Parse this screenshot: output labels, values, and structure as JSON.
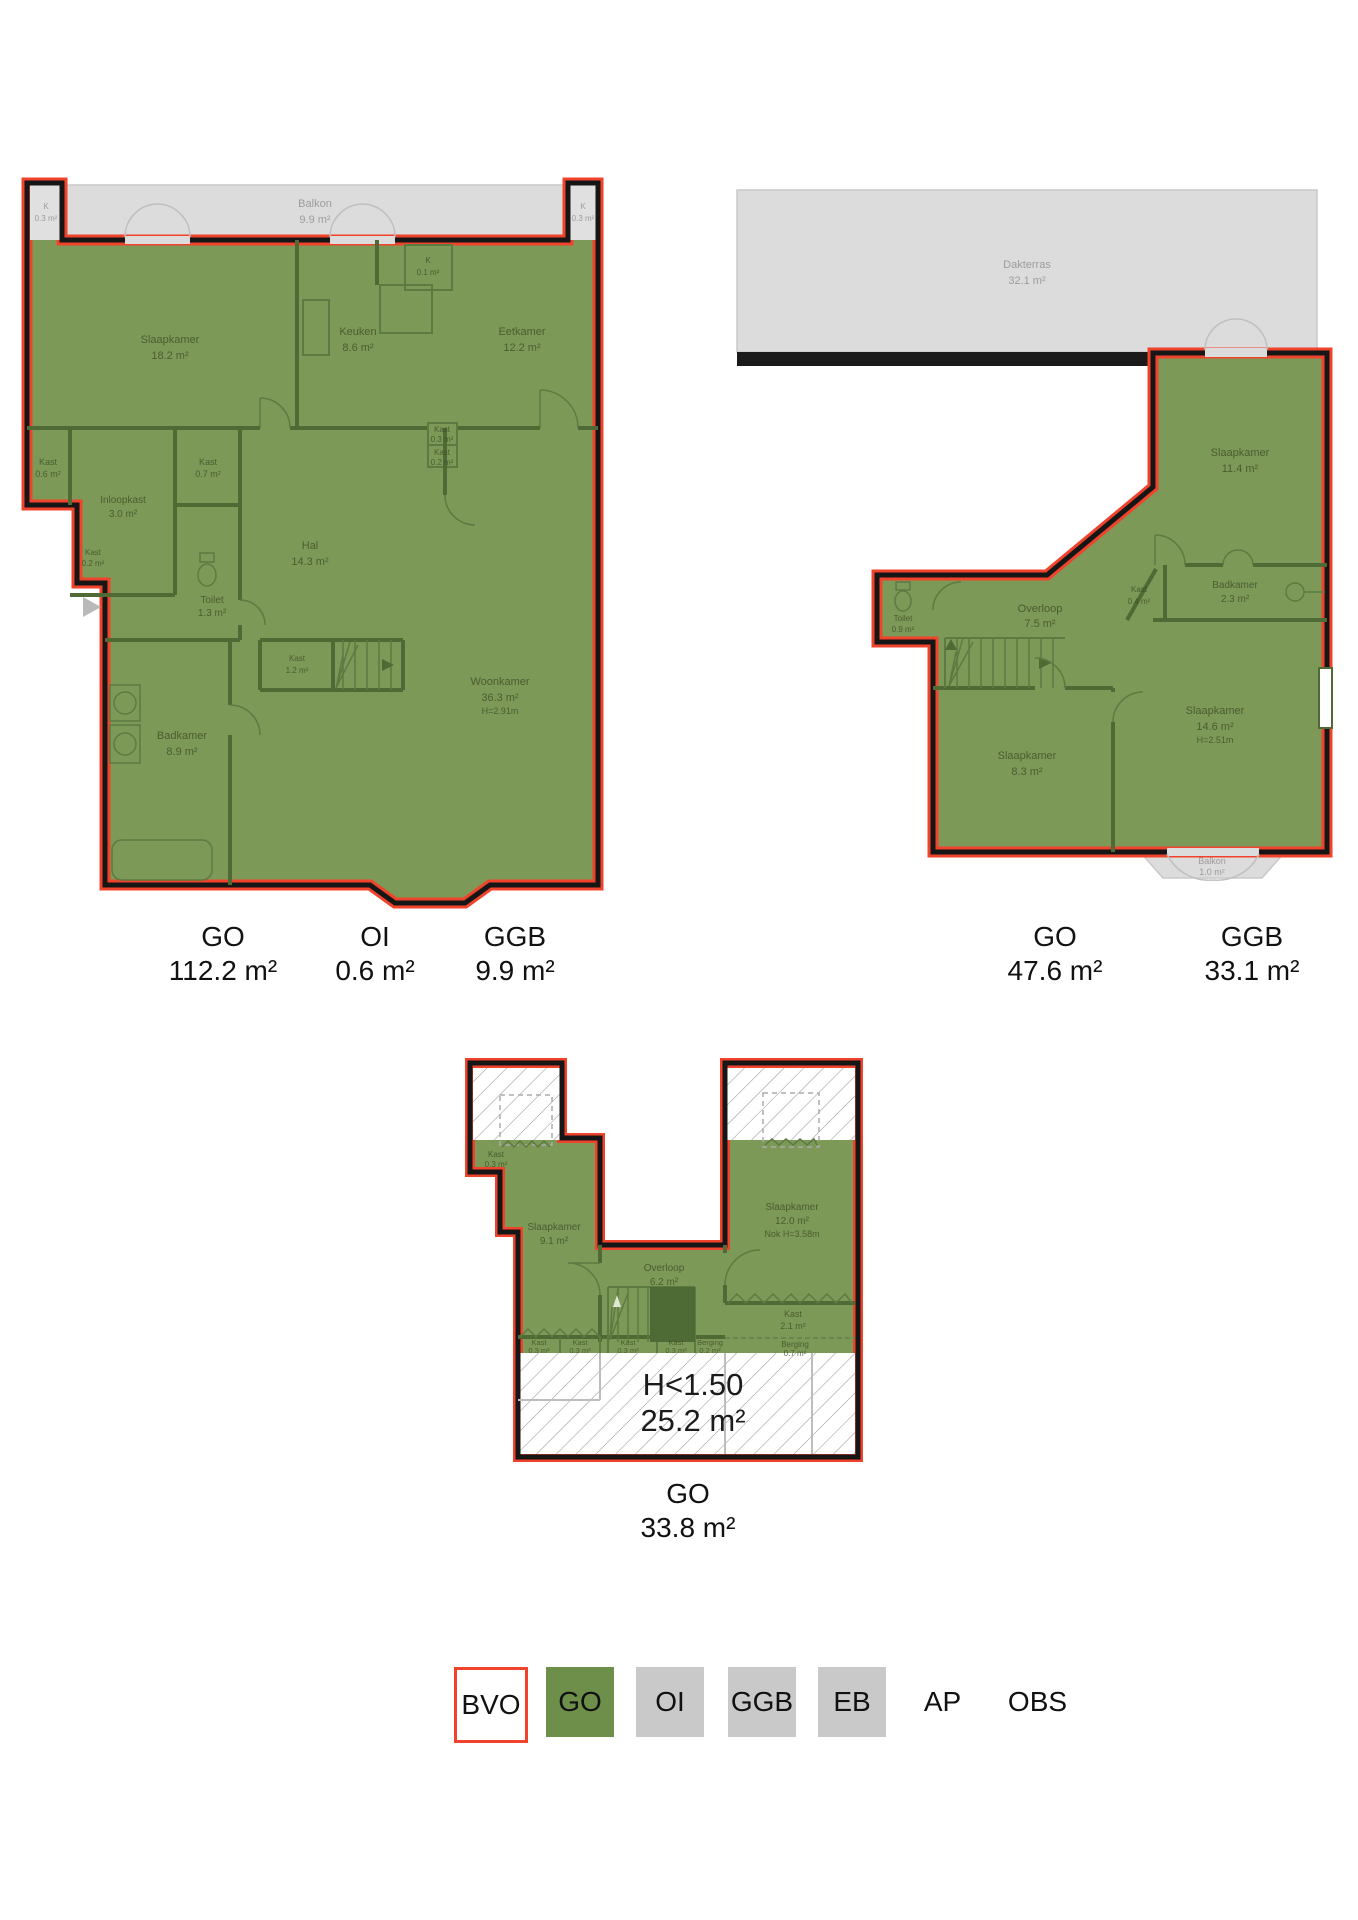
{
  "colors": {
    "bvo_red": "#f0432c",
    "go_green_fill": "#7d9957",
    "go_green_legend": "#6d8f4a",
    "ggb_gray": "#dcdcdc",
    "legend_gray": "#c9c9c9",
    "wall_black": "#161616",
    "wall_green": "#4f6a35"
  },
  "plan1": {
    "balkon": {
      "name": "Balkon",
      "area": "9.9 m²"
    },
    "k_left": {
      "name": "K",
      "area": "0.3 m²"
    },
    "k_right": {
      "name": "K",
      "area": "0.3 m²"
    },
    "rooms": {
      "slaapkamer": {
        "name": "Slaapkamer",
        "area": "18.2 m²"
      },
      "keuken": {
        "name": "Keuken",
        "area": "8.6 m²"
      },
      "k01": {
        "name": "K",
        "area": "0.1 m²"
      },
      "eetkamer": {
        "name": "Eetkamer",
        "area": "12.2 m²"
      },
      "kast03mid": {
        "name": "Kast",
        "area": "0.3 m²"
      },
      "kast02mid": {
        "name": "Kast",
        "area": "0.2 m²"
      },
      "kast06": {
        "name": "Kast",
        "area": "0.6 m²"
      },
      "inloopkast": {
        "name": "Inloopkast",
        "area": "3.0 m²"
      },
      "kast07": {
        "name": "Kast",
        "area": "0.7 m²"
      },
      "toilet": {
        "name": "Toilet",
        "area": "1.3 m²"
      },
      "hal": {
        "name": "Hal",
        "area": "14.3 m²"
      },
      "kast02left": {
        "name": "Kast",
        "area": "0.2 m²"
      },
      "kast12": {
        "name": "Kast",
        "area": "1.2 m²"
      },
      "badkamer": {
        "name": "Badkamer",
        "area": "8.9 m²"
      },
      "woonkamer": {
        "name": "Woonkamer",
        "area": "36.3 m²",
        "height": "H=2.91m"
      }
    },
    "measurements": [
      {
        "code": "GO",
        "value": "112.2 m²"
      },
      {
        "code": "OI",
        "value": "0.6 m²"
      },
      {
        "code": "GGB",
        "value": "9.9 m²"
      }
    ]
  },
  "plan2": {
    "dakterras": {
      "name": "Dakterras",
      "area": "32.1 m²"
    },
    "balkon": {
      "name": "Balkon",
      "area": "1.0 m²"
    },
    "rooms": {
      "slaapkamer114": {
        "name": "Slaapkamer",
        "area": "11.4 m²"
      },
      "toilet": {
        "name": "Toilet",
        "area": "0.9 m²"
      },
      "overloop": {
        "name": "Overloop",
        "area": "7.5 m²"
      },
      "kast04": {
        "name": "Kast",
        "area": "0.4 m²"
      },
      "badkamer": {
        "name": "Badkamer",
        "area": "2.3 m²"
      },
      "slaapkamer83": {
        "name": "Slaapkamer",
        "area": "8.3 m²"
      },
      "slaapkamer146": {
        "name": "Slaapkamer",
        "area": "14.6 m²",
        "height": "H=2.51m"
      }
    },
    "measurements": [
      {
        "code": "GO",
        "value": "47.6 m²"
      },
      {
        "code": "GGB",
        "value": "33.1 m²"
      }
    ]
  },
  "plan3": {
    "rooms": {
      "kast03tl": {
        "name": "Kast",
        "area": "0.3 m²"
      },
      "slaapkamer91": {
        "name": "Slaapkamer",
        "area": "9.1 m²"
      },
      "overloop": {
        "name": "Overloop",
        "area": "6.2 m²"
      },
      "slaapkamer120": {
        "name": "Slaapkamer",
        "area": "12.0 m²",
        "height": "Nok H=3.58m"
      },
      "kast21": {
        "name": "Kast",
        "area": "2.1 m²"
      },
      "kastA": {
        "name": "Kast",
        "area": "0.3 m²"
      },
      "kastB": {
        "name": "Kast",
        "area": "0.3 m²"
      },
      "kastC": {
        "name": "Kast",
        "area": "0.3 m²"
      },
      "kastD": {
        "name": "Kast",
        "area": "0.3 m²"
      },
      "berging02": {
        "name": "Berging",
        "area": "0.2 m²"
      },
      "berging07": {
        "name": "Berging",
        "area": "0.7 m²"
      }
    },
    "low_height": {
      "label": "H<1.50",
      "area": "25.2 m²"
    },
    "measurements": [
      {
        "code": "GO",
        "value": "33.8 m²"
      }
    ]
  },
  "legend": {
    "items": [
      {
        "code": "BVO",
        "style": "outline"
      },
      {
        "code": "GO",
        "style": "green"
      },
      {
        "code": "OI",
        "style": "gray"
      },
      {
        "code": "GGB",
        "style": "gray"
      },
      {
        "code": "EB",
        "style": "gray"
      },
      {
        "code": "AP",
        "style": "none"
      },
      {
        "code": "OBS",
        "style": "none"
      }
    ]
  }
}
